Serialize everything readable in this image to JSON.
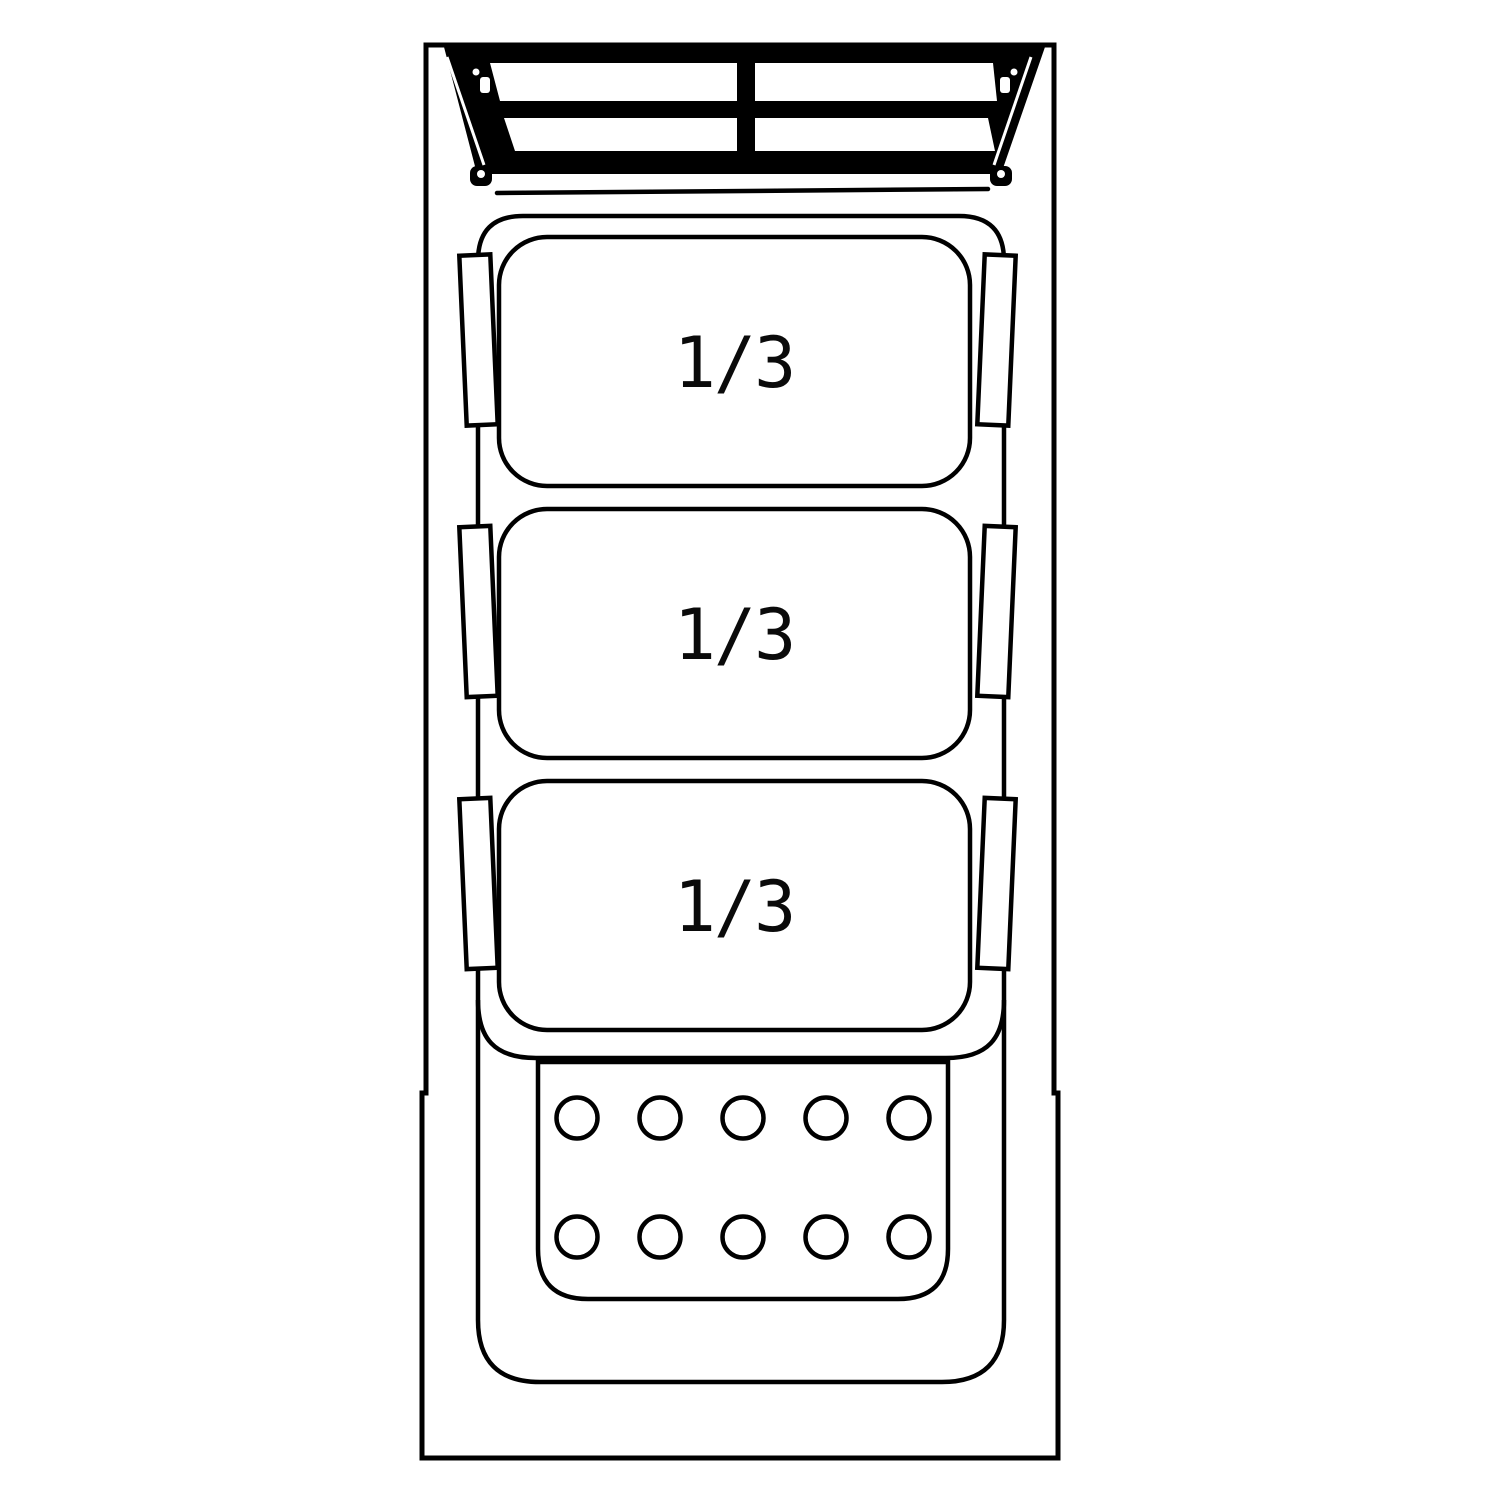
{
  "pans": [
    {
      "label": "1/3"
    },
    {
      "label": "1/3"
    },
    {
      "label": "1/3"
    }
  ],
  "tray": {
    "hole_rows": 2,
    "holes_per_row": 5
  },
  "colors": {
    "line": "#000000",
    "background": "#ffffff"
  }
}
